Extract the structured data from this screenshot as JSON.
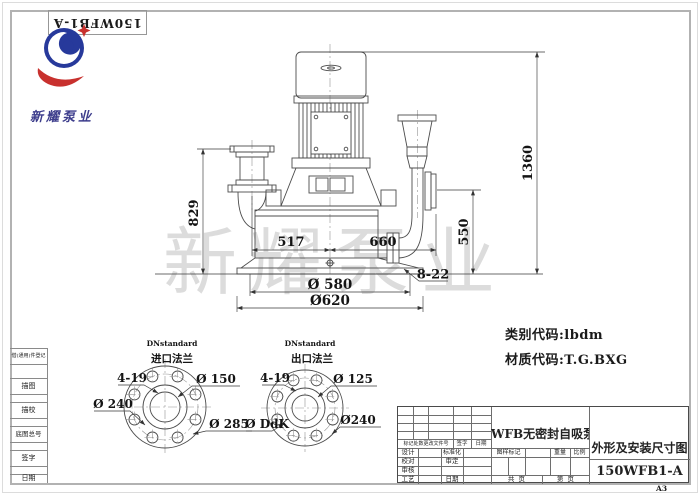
{
  "header": {
    "top_box_number": "150WFB1-A",
    "company": "新耀泵业"
  },
  "watermark": "新耀泵业",
  "margin_column": {
    "register": "借(通用)件登记",
    "rows": [
      "描图",
      "描校",
      "底图总号",
      "签字",
      "日期"
    ]
  },
  "drawing": {
    "dims": {
      "total_height": "1360",
      "inlet_height": "829",
      "outlet_height": "550",
      "inlet_offset": "517",
      "outlet_offset": "660",
      "anchor_holes": "8-22",
      "bolt_circle": "Ø 580",
      "base_diameter": "Ø620"
    },
    "notes": {
      "category": "类别代码:lbdm",
      "material": "材质代码:T.G.BXG"
    }
  },
  "flange_views": {
    "inlet": {
      "standard": "DNstandard",
      "title": "进口法兰",
      "holes": "4-19",
      "inner": "Ø 150",
      "bolt_circle": "Ø 240",
      "outer": "Ø 285"
    },
    "outlet": {
      "standard": "DNstandard",
      "title": "出口法兰",
      "holes": "4-19",
      "inner": "Ø 125",
      "bolt_circle": "Ø DdK",
      "outer": "Ø240"
    }
  },
  "title_block": {
    "revision_header": [
      "标记处数更改文件号",
      "签字",
      "日期"
    ],
    "sign_rows": [
      {
        "left": "设计",
        "right": "标准化"
      },
      {
        "left": "校对",
        "right": "审定"
      },
      {
        "left": "审核",
        "right": ""
      },
      {
        "left": "工艺",
        "right": "日期"
      }
    ],
    "product_name": "WFB无密封自吸泵",
    "stamp": {
      "mark": "图样标记",
      "weight": "重量",
      "scale": "比例"
    },
    "pages": {
      "total": "共  页",
      "current": "第  页"
    },
    "drawing_title": "外形及安装尺寸图",
    "drawing_number": "150WFB1-A",
    "sheet": "A3"
  }
}
